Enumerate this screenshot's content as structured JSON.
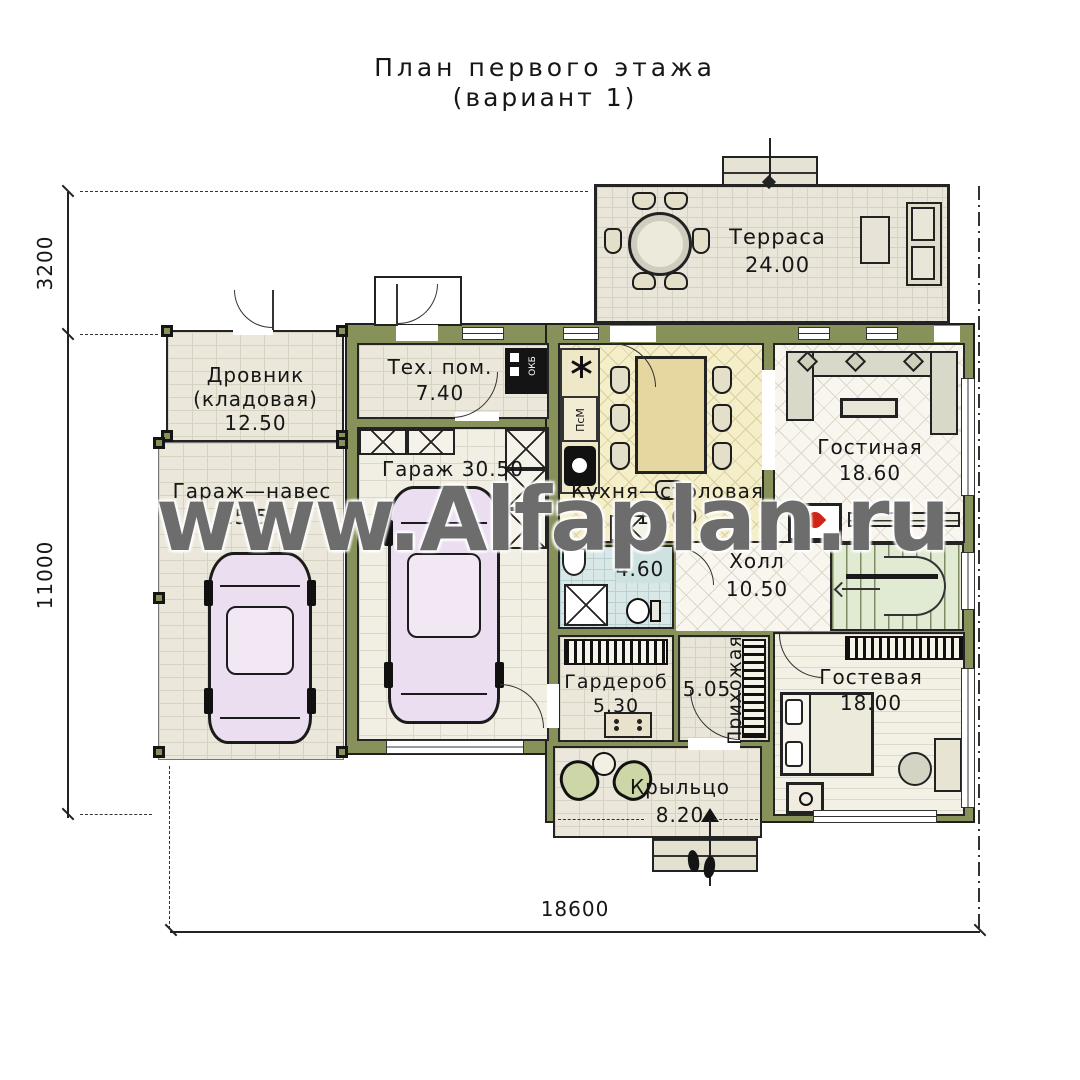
{
  "title": {
    "line1": "План первого этажа",
    "line2": "(вариант 1)"
  },
  "watermark": "www.Alfaplan.ru",
  "dims": {
    "left_upper": "3200",
    "left_lower": "11000",
    "bottom": "18600"
  },
  "rooms": {
    "terrace": {
      "name": "Терраса",
      "area": "24.00"
    },
    "woodshed": {
      "name": "Дровник",
      "name2": "(кладовая)",
      "area": "12.50"
    },
    "carport": {
      "name": "Гараж—навес",
      "area": "25.50"
    },
    "tech": {
      "name": "Тех. пом.",
      "area": "7.40"
    },
    "garage": {
      "name": "Гараж",
      "area": "30.50"
    },
    "kitchen": {
      "name": "Кухня—столовая",
      "area": "18.60"
    },
    "living": {
      "name": "Гостиная",
      "area": "18.60"
    },
    "hall": {
      "name": "Холл",
      "area": "10.50"
    },
    "bathroom": {
      "area": "4.60"
    },
    "wardrobe": {
      "name": "Гардероб",
      "area": "5.30"
    },
    "entry": {
      "name": "Прихожая",
      "area": "5.05"
    },
    "guest": {
      "name": "Гостевая",
      "area": "18.00"
    },
    "porch": {
      "name": "Крыльцо",
      "area": "8.20"
    }
  },
  "appliances": {
    "dishwasher": "ПсМ",
    "boiler": "ОКБ"
  },
  "colors": {
    "wall_olive": "#87925a",
    "flame_red": "#cf2418"
  }
}
